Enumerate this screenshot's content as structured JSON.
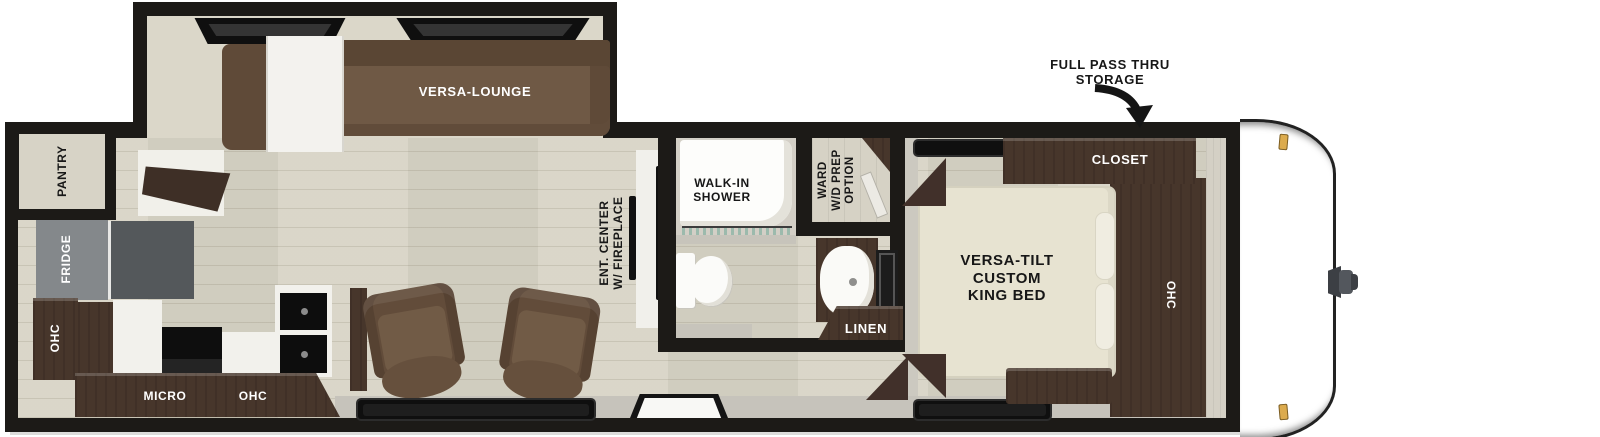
{
  "colors": {
    "wall": "#1c1a17",
    "floor_wood": "#d8d4c6",
    "cabinet_brown": "#47362b",
    "sofa_brown": "#6c5642",
    "bed_cream": "#e7e3d1",
    "fridge_gray": "#82868a",
    "marker_light_amber": "#dcab4e",
    "shower_glass_teal": "#7fae9f"
  },
  "callout": {
    "line1": "FULL PASS THRU",
    "line2": "STORAGE"
  },
  "slideout": {
    "lounge": "VERSA-LOUNGE"
  },
  "kitchen": {
    "pantry": "PANTRY",
    "fridge": "FRIDGE",
    "ohc_side": "OHC",
    "micro": "MICRO",
    "ohc_upper": "OHC"
  },
  "living": {
    "ent_line1": "ENT. CENTER",
    "ent_line2": "W/ FIREPLACE"
  },
  "bath": {
    "shower_line1": "WALK-IN",
    "shower_line2": "SHOWER",
    "linen": "LINEN"
  },
  "ward": {
    "line1": "WARD",
    "line2": "W/D PREP",
    "line3": "OPTION"
  },
  "bedroom": {
    "closet": "CLOSET",
    "bed_line1": "VERSA-TILT",
    "bed_line2": "CUSTOM",
    "bed_line3": "KING BED",
    "ohc": "OHC"
  }
}
